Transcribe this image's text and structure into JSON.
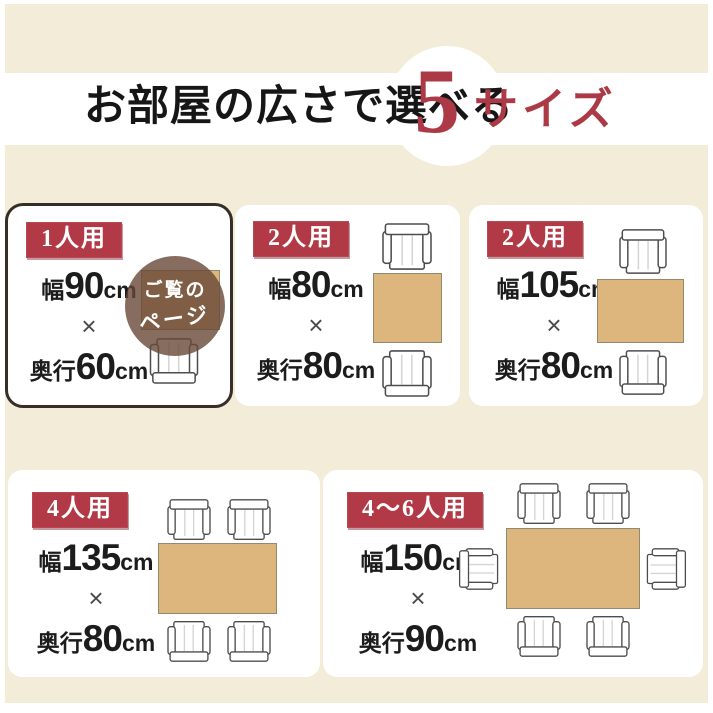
{
  "header": {
    "title": "お部屋の広さで選べる",
    "count": "5",
    "count_suffix": "サイズ"
  },
  "current_page_overlay": {
    "line1": "ご覧の",
    "line2": "ページ"
  },
  "cards": [
    {
      "badge": "1人用",
      "width_prefix": "幅",
      "width_value": "90",
      "width_unit": "cm",
      "times": "×",
      "depth_prefix": "奥行",
      "depth_value": "60",
      "depth_unit": "cm",
      "highlighted": true,
      "chairs": 1
    },
    {
      "badge": "2人用",
      "width_prefix": "幅",
      "width_value": "80",
      "width_unit": "cm",
      "times": "×",
      "depth_prefix": "奥行",
      "depth_value": "80",
      "depth_unit": "cm",
      "highlighted": false,
      "chairs": 2
    },
    {
      "badge": "2人用",
      "width_prefix": "幅",
      "width_value": "105",
      "width_unit": "cm",
      "times": "×",
      "depth_prefix": "奥行",
      "depth_value": "80",
      "depth_unit": "cm",
      "highlighted": false,
      "chairs": 2
    },
    {
      "badge": "4人用",
      "width_prefix": "幅",
      "width_value": "135",
      "width_unit": "cm",
      "times": "×",
      "depth_prefix": "奥行",
      "depth_value": "80",
      "depth_unit": "cm",
      "highlighted": false,
      "chairs": 4
    },
    {
      "badge": "4〜6人用",
      "width_prefix": "幅",
      "width_value": "150",
      "width_unit": "cm",
      "times": "×",
      "depth_prefix": "奥行",
      "depth_value": "90",
      "depth_unit": "cm",
      "highlighted": false,
      "chairs": 6
    }
  ],
  "colors": {
    "accent_red": "#ac3a46",
    "badge_red": "#b23a46",
    "cream_background": "#f2ecd9",
    "table_wood": "#dcb67c",
    "highlight_border": "#362e27",
    "overlay_brown": "#694938"
  }
}
